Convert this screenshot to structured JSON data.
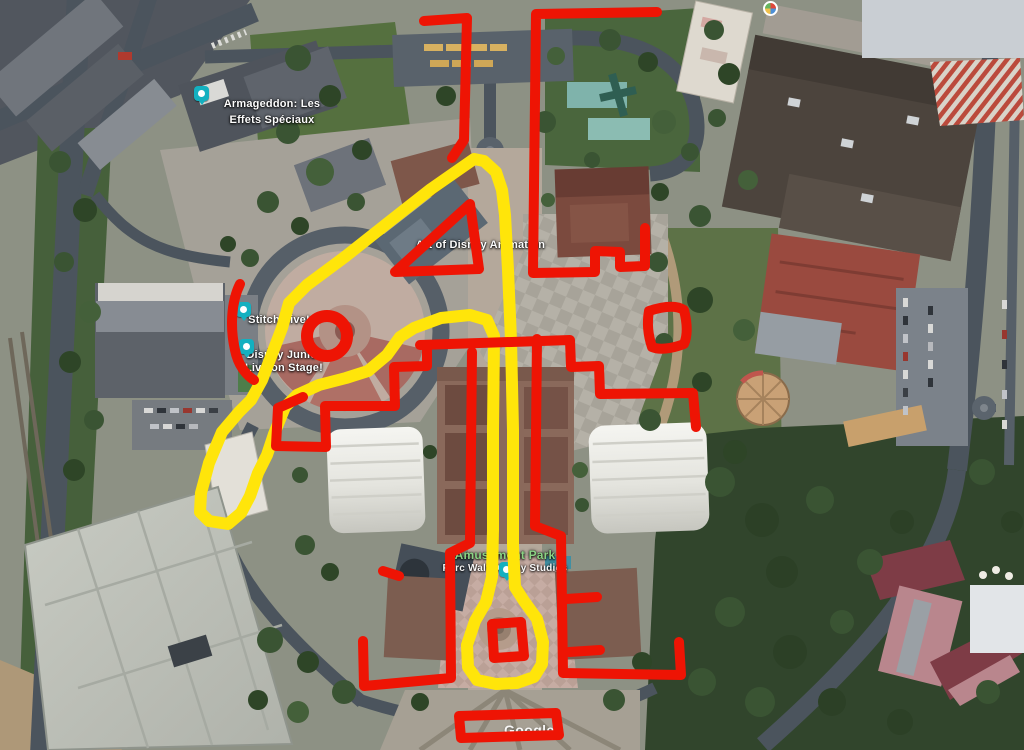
{
  "map": {
    "attribution": "Google",
    "annotation_colors": {
      "red": "#ee1404",
      "yellow": "#ffe50a"
    },
    "pin_color": "#14b0c0",
    "label_green": "#8bd284",
    "labels": {
      "armageddon_line1": "Armageddon: Les",
      "armageddon_line2": "Effets Spéciaux",
      "animation": "Art of Disney Animation",
      "stitch": "Stitch Live!",
      "disney_junior_line1": "Disney Junior",
      "disney_junior_line2": "Live on Stage!",
      "park_name": "Amusement Park",
      "park_subtitle": "Parc Walt Disney Studios"
    },
    "pins": [
      {
        "id": "armageddon",
        "kind": "attraction-pin"
      },
      {
        "id": "stitch-live",
        "kind": "attraction-pin"
      },
      {
        "id": "disney-junior",
        "kind": "attraction-pin"
      },
      {
        "id": "amusement-park",
        "kind": "park-pin"
      },
      {
        "id": "photo-poi",
        "kind": "photo-marker"
      }
    ]
  }
}
